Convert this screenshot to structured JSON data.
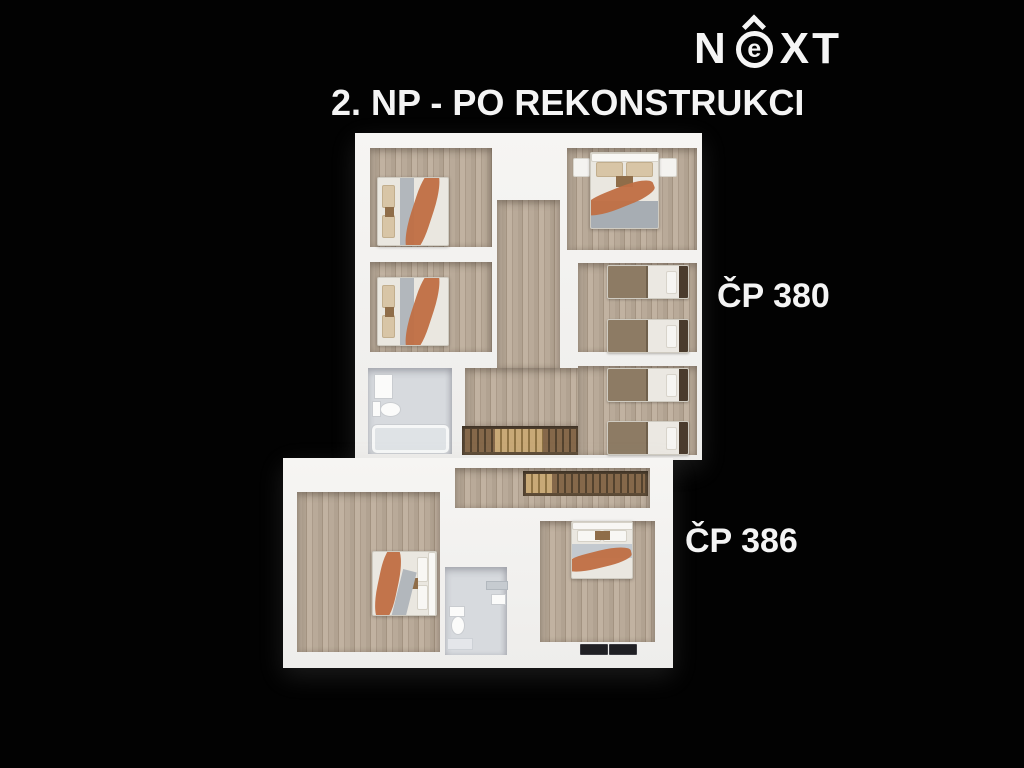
{
  "title": "2. NP - PO REKONSTRUKCI",
  "logo": {
    "brand": "NEXT",
    "part_n": "N",
    "part_e": "e",
    "part_xt": "XT"
  },
  "unit_labels": {
    "upper": "ČP 380",
    "lower": "ČP 386"
  },
  "colors": {
    "background": "#000000",
    "walls": "#f4f3f1",
    "wood_floor": "#b3a493",
    "bathroom_floor": "#d7dade",
    "stairs_dark": "#5f4d38",
    "stairs_light": "#c8a977",
    "throw_orange": "#c06f45",
    "blanket_gray": "#a7adb3",
    "blanket_brown": "#8d7b64",
    "headboard_dark": "#4a3b2d",
    "doormat_dark": "#202024"
  },
  "floorplan": {
    "type": "3d-floor-plan-render",
    "units": [
      {
        "label": "ČP 380",
        "position": "upper",
        "rooms": [
          "bedroom-top-left-double-bed",
          "bedroom-mid-left-double-bed",
          "bathroom-with-tub-and-toilet",
          "central-hallway-with-staircase",
          "bedroom-top-right-double-bed",
          "twin-single-bed-room-upper",
          "twin-single-bed-room-lower"
        ]
      },
      {
        "label": "ČP 386",
        "position": "lower",
        "rooms": [
          "corridor-with-staircase",
          "bedroom-left-double-bed",
          "bathroom-with-toilet",
          "bedroom-right-double-bed",
          "entry-with-two-doormats"
        ]
      }
    ]
  }
}
